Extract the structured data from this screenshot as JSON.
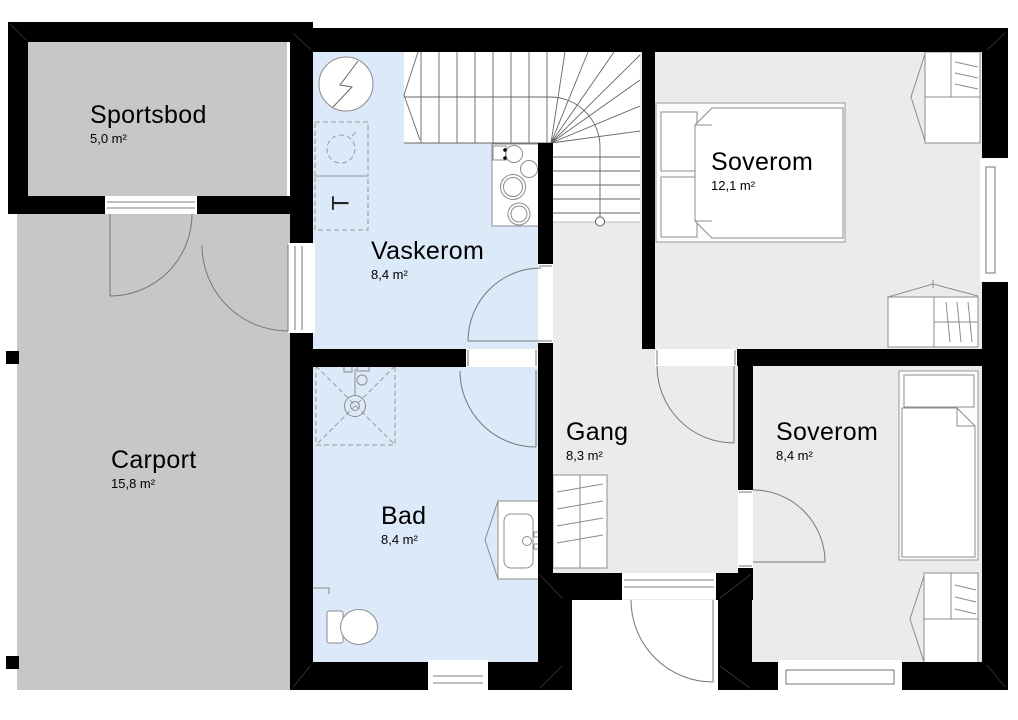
{
  "colors": {
    "wall": "#000000",
    "storage_fill": "#c7c7c7",
    "wet_room_fill": "#dce9f8",
    "room_fill": "#ebebeb",
    "furniture_stroke": "#8c8c8c",
    "background": "#ffffff"
  },
  "rooms": [
    {
      "name": "Sportsbod",
      "area": "5,0 m²"
    },
    {
      "name": "Carport",
      "area": "15,8 m²"
    },
    {
      "name": "Vaskerom",
      "area": "8,4 m²"
    },
    {
      "name": "Bad",
      "area": "8,4 m²"
    },
    {
      "name": "Gang",
      "area": "8,3 m²"
    },
    {
      "name": "Soverom",
      "area": "12,1 m²"
    },
    {
      "name": "Soverom",
      "area": "8,4 m²"
    }
  ],
  "symbols": {
    "dryer_label": "T"
  }
}
